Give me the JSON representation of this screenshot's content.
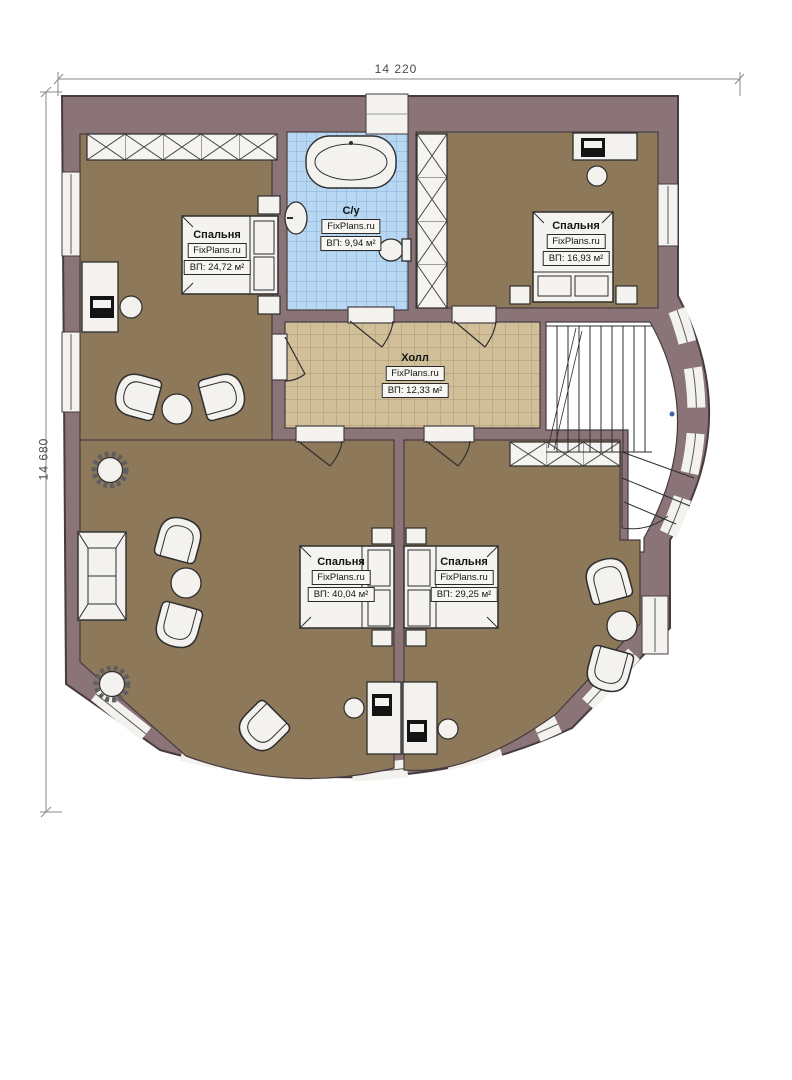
{
  "plan": {
    "title": "Second floor plan",
    "watermark": "FixPlans.ru",
    "dimensions": {
      "width_mm": "14 220",
      "height_mm": "14 680"
    },
    "rooms": [
      {
        "id": "bedroom-top-left",
        "name": "Спальня",
        "area": "ВП: 24,72 м²"
      },
      {
        "id": "bathroom",
        "name": "С/у",
        "area": "ВП: 9,94 м²"
      },
      {
        "id": "bedroom-top-right",
        "name": "Спальня",
        "area": "ВП: 16,93 м²"
      },
      {
        "id": "hall",
        "name": "Холл",
        "area": "ВП: 12,33 м²"
      },
      {
        "id": "bedroom-bottom-left",
        "name": "Спальня",
        "area": "ВП: 40,04 м²"
      },
      {
        "id": "bedroom-bottom-right",
        "name": "Спальня",
        "area": "ВП: 29,25 м²"
      }
    ],
    "colors": {
      "wall": "#8b7478",
      "wall_outline": "#463b41",
      "floor_wood": "#8d785a",
      "hall_floor": "#d1bf9a",
      "hall_grid": "#ab9770",
      "bath_floor": "#b8d7f2",
      "bath_grid": "#88afd8",
      "furniture": "#f3f2ef",
      "furniture_line": "#2e2e2e",
      "dimension_line": "#8a8a8a",
      "stair_dot": "#4a5fae"
    }
  }
}
